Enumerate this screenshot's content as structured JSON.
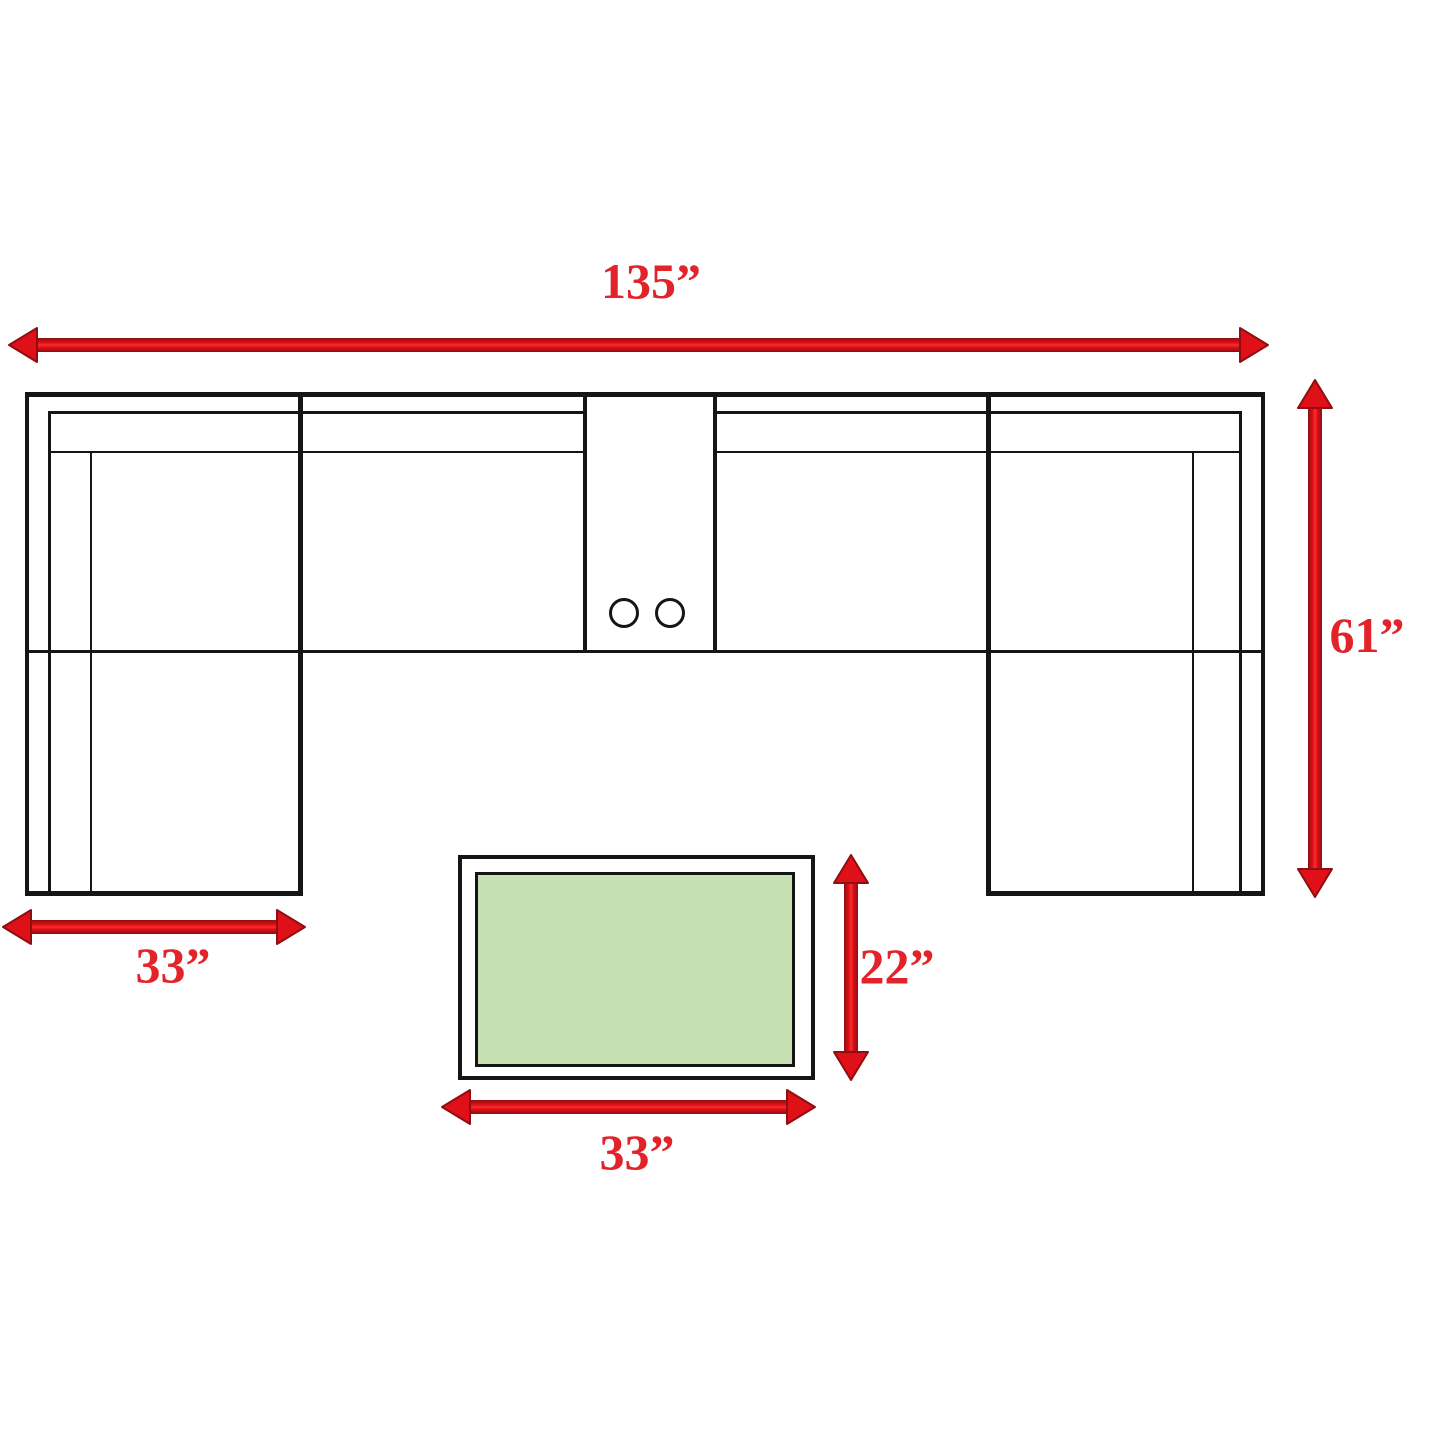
{
  "figure": {
    "type": "furniture-dimension-diagram",
    "pieces": [
      {
        "name": "u-shaped-sectional-sofa",
        "width_label": "135”",
        "depth_label": "61”",
        "chaise_width_label": "33”",
        "features": [
          "left-chaise",
          "right-chaise",
          "center-console-with-two-cupholders"
        ]
      },
      {
        "name": "coffee-table",
        "width_label": "33”",
        "depth_label": "22”",
        "top_fill": "light-green"
      }
    ]
  },
  "diagram": {
    "colors": {
      "background": "#ffffff",
      "outline": "#151515",
      "arrow_red": "#e01018",
      "arrow_dark": "#8f0e11",
      "label_red": "#e2232a",
      "table_fill": "#c6e0b4"
    },
    "labels": [
      {
        "id": "sofa-width",
        "text": "135”",
        "x": 651,
        "y": 281
      },
      {
        "id": "sofa-depth",
        "text": "61”",
        "x": 1367,
        "y": 635
      },
      {
        "id": "left-chaise-width",
        "text": "33”",
        "x": 173,
        "y": 965
      },
      {
        "id": "table-depth",
        "text": "22”",
        "x": 897,
        "y": 966
      },
      {
        "id": "table-width",
        "text": "33”",
        "x": 637,
        "y": 1152
      }
    ],
    "arrows": [
      {
        "id": "sofa-width-arrow",
        "dir": "h",
        "x1": 9,
        "x2": 1268,
        "y": 345
      },
      {
        "id": "sofa-depth-arrow",
        "dir": "v",
        "x": 1315,
        "y1": 380,
        "y2": 897
      },
      {
        "id": "left-chaise-width-arrow",
        "dir": "h",
        "x1": 3,
        "x2": 305,
        "y": 927
      },
      {
        "id": "table-width-arrow",
        "dir": "h",
        "x1": 442,
        "x2": 815,
        "y": 1107
      },
      {
        "id": "table-depth-arrow",
        "dir": "v",
        "x": 851,
        "y1": 855,
        "y2": 1080
      }
    ],
    "sofa": {
      "h_lines": [
        {
          "x": 25,
          "y": 392,
          "w": 1240,
          "t": 5
        },
        {
          "x": 48,
          "y": 411,
          "w": 537,
          "t": 3
        },
        {
          "x": 713,
          "y": 411,
          "w": 529,
          "t": 3
        },
        {
          "x": 48,
          "y": 451,
          "w": 537,
          "t": 2
        },
        {
          "x": 713,
          "y": 451,
          "w": 529,
          "t": 2
        },
        {
          "x": 25,
          "y": 650,
          "w": 1240,
          "t": 3
        },
        {
          "x": 25,
          "y": 891,
          "w": 278,
          "t": 5
        },
        {
          "x": 986,
          "y": 891,
          "w": 279,
          "t": 5
        }
      ],
      "v_lines": [
        {
          "x": 25,
          "y": 392,
          "h": 504,
          "t": 4
        },
        {
          "x": 48,
          "y": 411,
          "h": 483,
          "t": 3
        },
        {
          "x": 90,
          "y": 451,
          "h": 443,
          "t": 2
        },
        {
          "x": 298,
          "y": 392,
          "h": 504,
          "t": 5
        },
        {
          "x": 583,
          "y": 392,
          "h": 261,
          "t": 4
        },
        {
          "x": 713,
          "y": 392,
          "h": 261,
          "t": 4
        },
        {
          "x": 986,
          "y": 392,
          "h": 504,
          "t": 5
        },
        {
          "x": 1192,
          "y": 451,
          "h": 443,
          "t": 2
        },
        {
          "x": 1239,
          "y": 411,
          "h": 483,
          "t": 3
        },
        {
          "x": 1261,
          "y": 392,
          "h": 504,
          "t": 4
        }
      ],
      "cupholders": [
        {
          "cx": 624,
          "cy": 613,
          "r": 15
        },
        {
          "cx": 670,
          "cy": 613,
          "r": 15
        }
      ]
    },
    "table": {
      "outer": {
        "x": 458,
        "y": 855,
        "w": 357,
        "h": 225,
        "border": 4
      },
      "inner": {
        "x": 475,
        "y": 872,
        "w": 320,
        "h": 195,
        "border": 3
      }
    }
  }
}
